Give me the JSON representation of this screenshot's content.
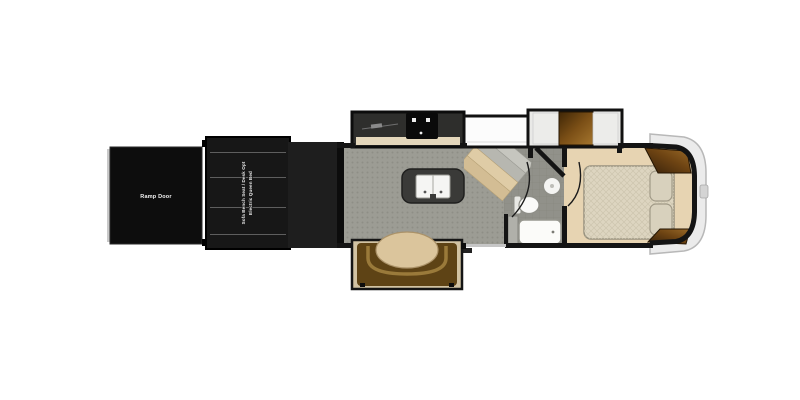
{
  "floorplan": {
    "type": "fifth-wheel toy hauler floorplan, side profile top-down view",
    "labels": {
      "ramp_door": "Ramp Door",
      "garage_bed_line1": "Electric Queen Bed",
      "garage_bed_line2": "Sofa Bench Seat / Desk Opt"
    },
    "colors": {
      "background": "#ffffff",
      "wall": "#141414",
      "ramp_door": "#0d0d0d",
      "garage_slideout": "#171717",
      "garage_divider_line": "#5e5e5e",
      "kitchen_floor": "#9c9c94",
      "bathroom_floor": "#91918a",
      "bedroom_floor": "#e7d4b2",
      "kitchen_slide_interior": "#2e2e2c",
      "counter_top": "#e4d7bb",
      "island": "#3a3a38",
      "sink": "#f5f5f3",
      "refrigerator": "#fcfcfc",
      "booth": "#5e4315",
      "dinette_table": "#dbc59c",
      "wood_dark": "#3f2606",
      "wood_light": "#a5762e",
      "mattress": "#ddd5c0",
      "pillow": "#d8d1bd",
      "front_cap": "#ebebeb",
      "front_cap_edge": "#b8b8b8",
      "entry_threshold": "#c6c6c6"
    }
  }
}
